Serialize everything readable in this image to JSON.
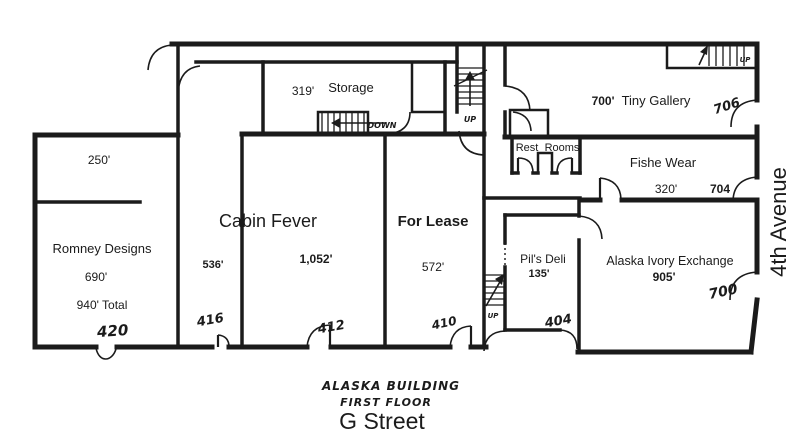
{
  "title": {
    "building": "ALASKA BUILDING",
    "floor": "FIRST FLOOR"
  },
  "streets": {
    "bottom": "G Street",
    "right": "4th Avenue"
  },
  "stairs": {
    "up": "UP",
    "down": "DOWN"
  },
  "rooms": {
    "upper_left": {
      "sqft": "250'"
    },
    "romney": {
      "name": "Romney Designs",
      "sqft": "690'",
      "total": "940' Total",
      "unit": "420"
    },
    "unit_416": {
      "sqft": "536'",
      "unit": "416"
    },
    "cabin_fever": {
      "name": "Cabin Fever",
      "sqft": "1,052'",
      "unit": "412"
    },
    "for_lease": {
      "name": "For Lease",
      "sqft": "572'",
      "unit": "410"
    },
    "storage": {
      "name": "Storage",
      "sqft": "319'"
    },
    "tiny_gallery": {
      "name": "Tiny Gallery",
      "sqft": "700'",
      "unit": "706"
    },
    "fishe_wear": {
      "name": "Fishe Wear",
      "sqft": "320'",
      "unit": "704"
    },
    "restrooms": {
      "word1": "Rest",
      "word2": "Rooms"
    },
    "pils_deli": {
      "name": "Pil's Deli",
      "sqft": "135'",
      "unit": "404"
    },
    "ivory_exchange": {
      "name": "Alaska Ivory Exchange",
      "sqft": "905'",
      "unit": "700"
    }
  },
  "colors": {
    "ink": "#1b1b1b",
    "background": "#ffffff"
  }
}
